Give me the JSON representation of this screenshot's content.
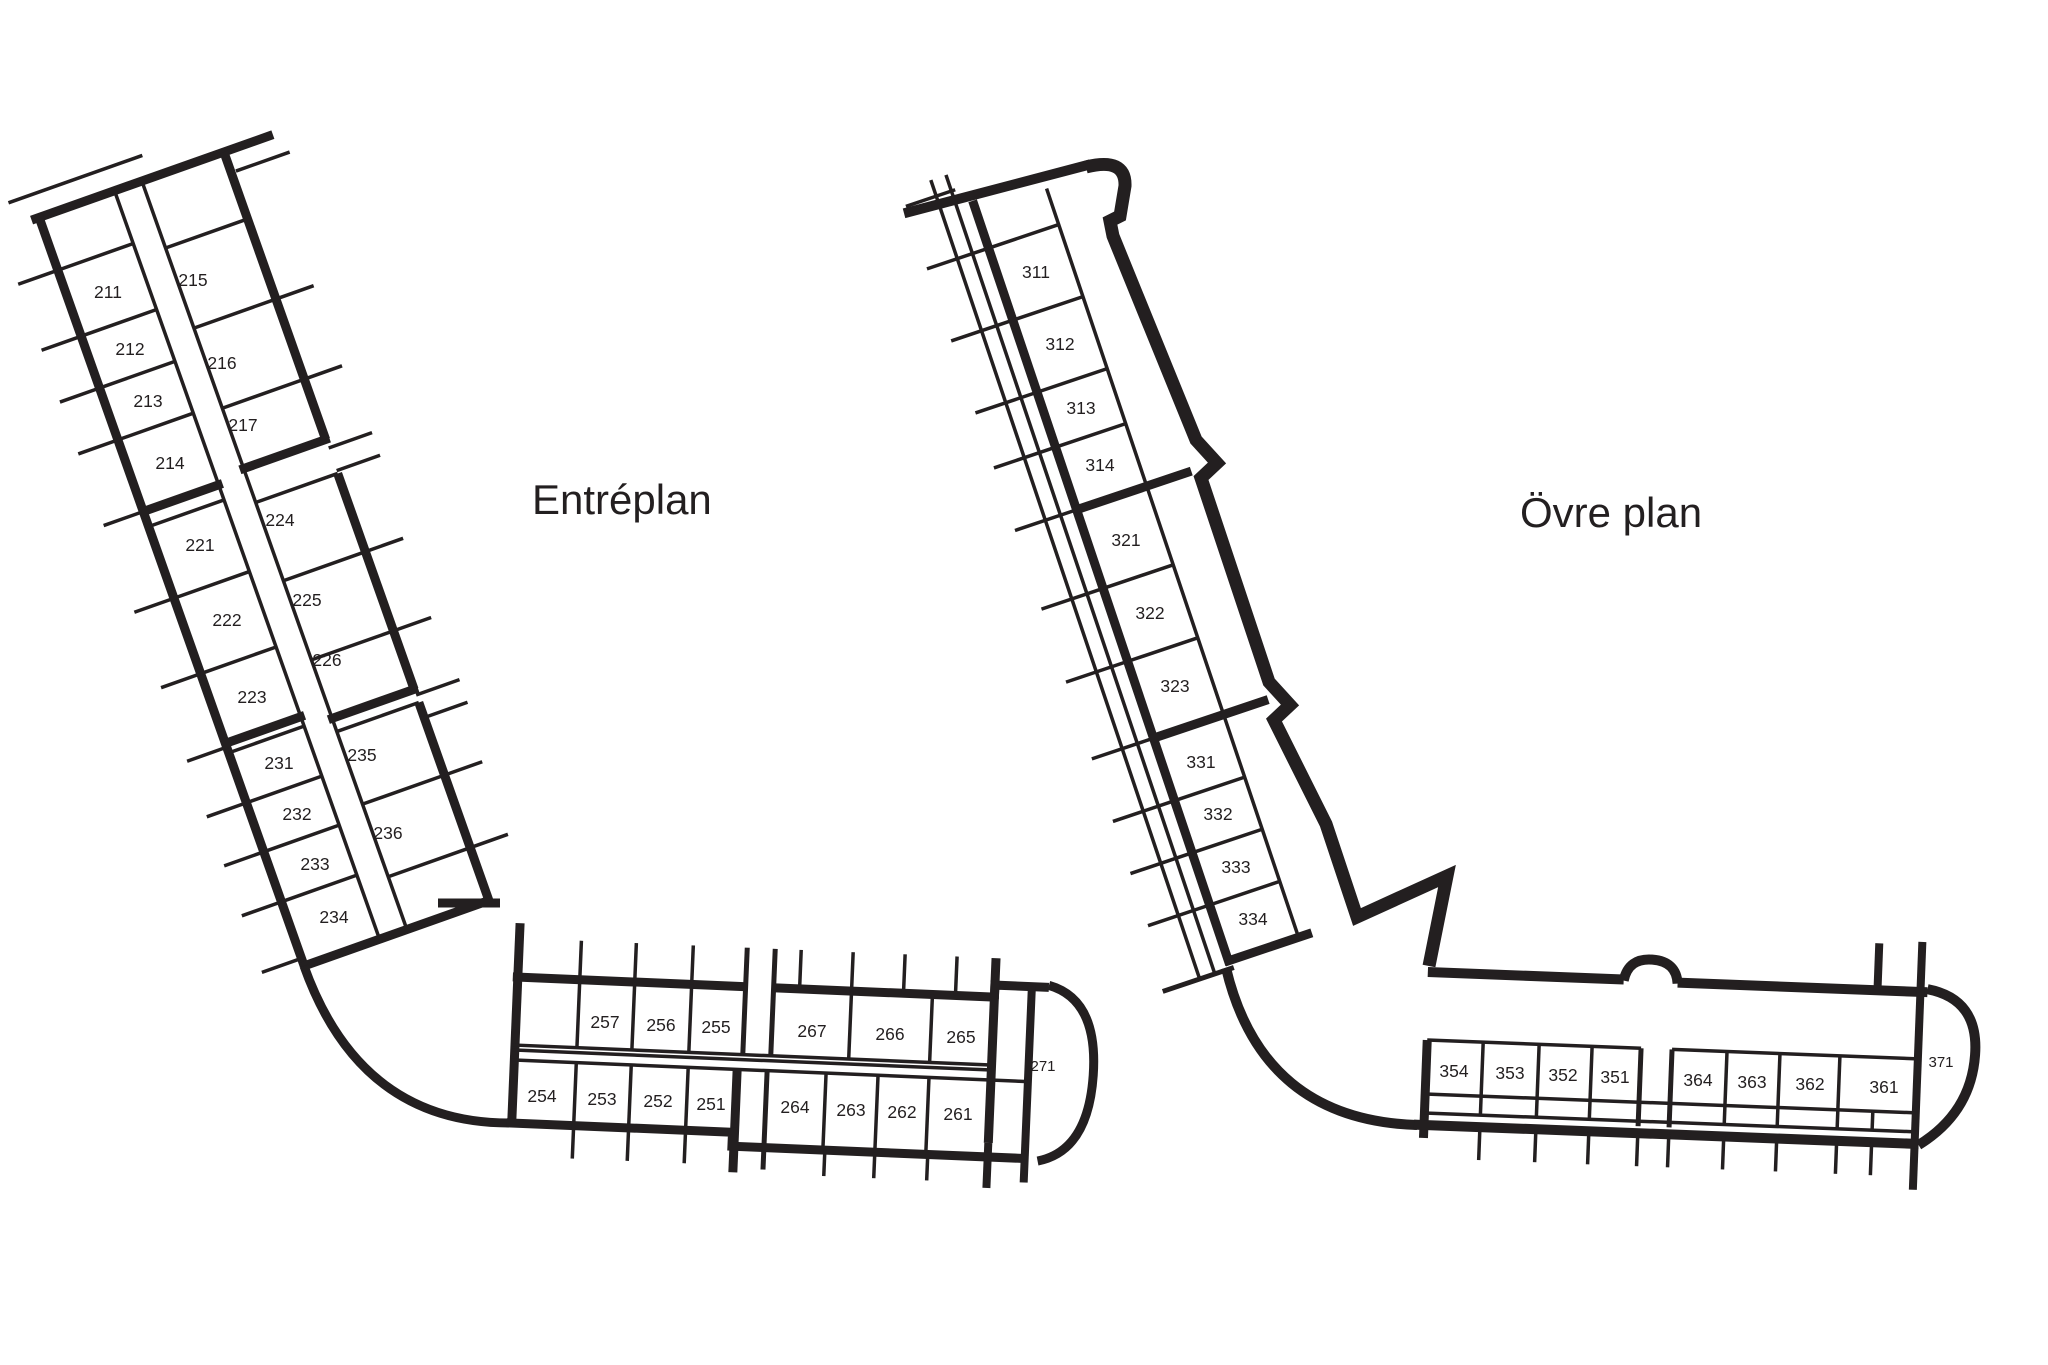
{
  "canvas": {
    "background": "#ffffff",
    "ink": "#231f20"
  },
  "plans": [
    {
      "title": "Entréplan",
      "wing_left_rooms": [
        "211",
        "212",
        "213",
        "214",
        "221",
        "222",
        "223",
        "231",
        "232",
        "233",
        "234"
      ],
      "wing_right_rooms": [
        "215",
        "216",
        "217",
        "224",
        "225",
        "226",
        "235",
        "236"
      ],
      "base_top_rooms": [
        "257",
        "256",
        "255",
        "267",
        "266",
        "265"
      ],
      "base_bottom_rooms": [
        "254",
        "253",
        "252",
        "251",
        "264",
        "263",
        "262",
        "261"
      ],
      "end_room": "271"
    },
    {
      "title": "Övre plan",
      "wing_rooms": [
        "311",
        "312",
        "313",
        "314",
        "321",
        "322",
        "323",
        "331",
        "332",
        "333",
        "334"
      ],
      "base_rooms": [
        "354",
        "353",
        "352",
        "351",
        "364",
        "363",
        "362",
        "361"
      ],
      "end_room": "371"
    }
  ]
}
